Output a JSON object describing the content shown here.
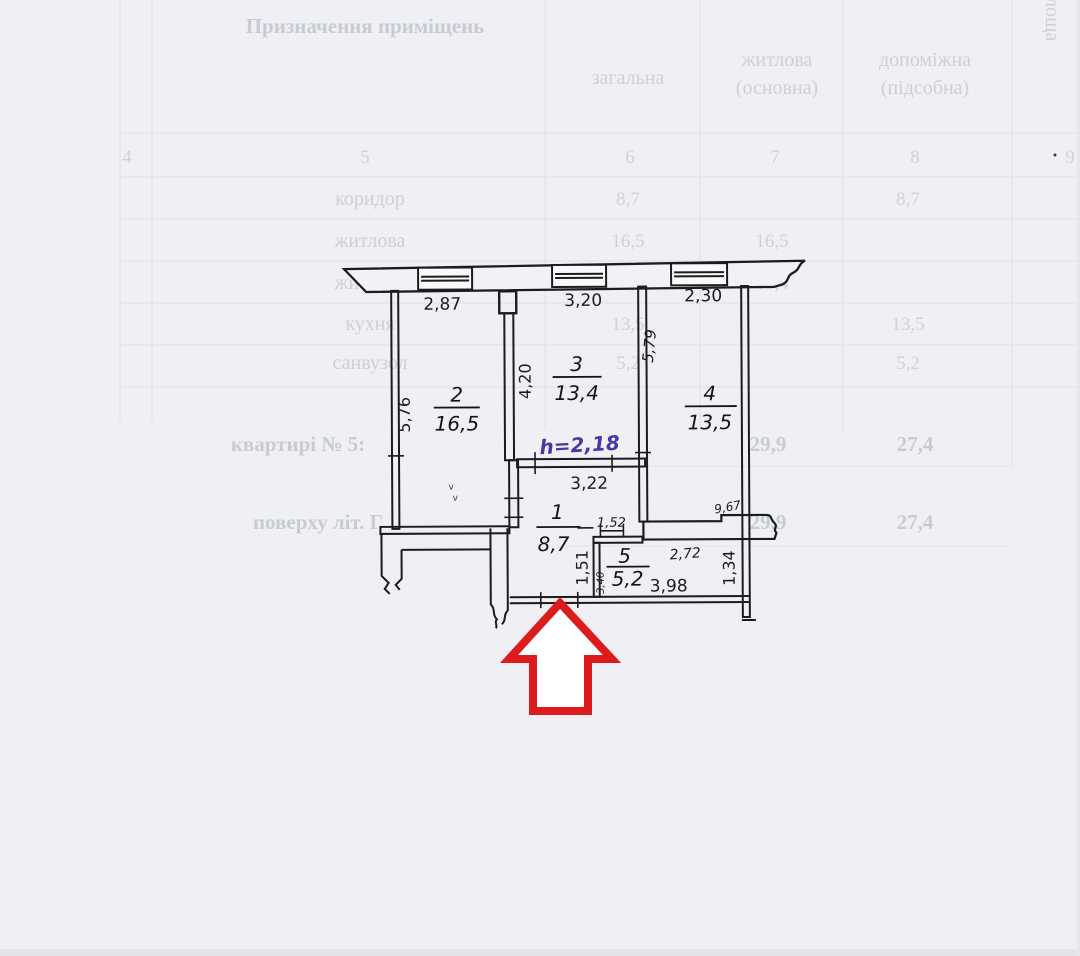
{
  "ghost_table": {
    "purpose_header": "Призначення приміщень",
    "col_total": "загальна",
    "col_living_line1": "житлова",
    "col_living_line2": "(основна)",
    "col_aux_line1": "допоміжна",
    "col_aux_line2": "(підсобна)",
    "col_side_vertical": "Площа",
    "col_numbers": [
      "4",
      "5",
      "6",
      "7",
      "8",
      "9"
    ],
    "rows": [
      {
        "name": "коридор",
        "total": "8,7",
        "living": "",
        "aux": "8,7"
      },
      {
        "name": "житлова",
        "total": "16,5",
        "living": "16,5",
        "aux": ""
      },
      {
        "name": "житлова",
        "total": "13,4",
        "living": "13,4",
        "aux": ""
      },
      {
        "name": "кухня",
        "total": "13,5",
        "living": "",
        "aux": "13,5"
      },
      {
        "name": "санвузол",
        "total": "5,2",
        "living": "",
        "aux": "5,2"
      }
    ],
    "summary_rows": [
      {
        "label": "квартирі № 5:",
        "living_total": "29,9",
        "aux_total": "27,4"
      },
      {
        "label": "поверху літ. Г",
        "living_total": "29,9",
        "aux_total": "27,4"
      }
    ]
  },
  "plan": {
    "rooms": [
      {
        "number": "1",
        "area": "8,7"
      },
      {
        "number": "2",
        "area": "16,5"
      },
      {
        "number": "3",
        "area": "13,4"
      },
      {
        "number": "4",
        "area": "13,5"
      },
      {
        "number": "5",
        "area": "5,2"
      }
    ],
    "dims": {
      "top": [
        "2,87",
        "3,20",
        "2,30"
      ],
      "room2_left": "5,76",
      "room3_left": "4,20",
      "room4_right_wall": "5,79",
      "mid_wall": "3,22",
      "hall_left": "1,51",
      "bath_top": "1,52",
      "bath_side": "3,40",
      "strip_width": "2,72",
      "wall_step": "9,67",
      "strip_height": "1,34",
      "bottom": "3,98"
    },
    "height_note": "h=2,18",
    "stray_marks": {
      "m1": "v",
      "m2": "v"
    }
  },
  "colors": {
    "ink": "#1c1c1e",
    "blue_note": "#433aa8",
    "arrow_red": "#dc1c1c",
    "paper": "#f0eff3",
    "ghost_text": "#ccd2cf"
  }
}
